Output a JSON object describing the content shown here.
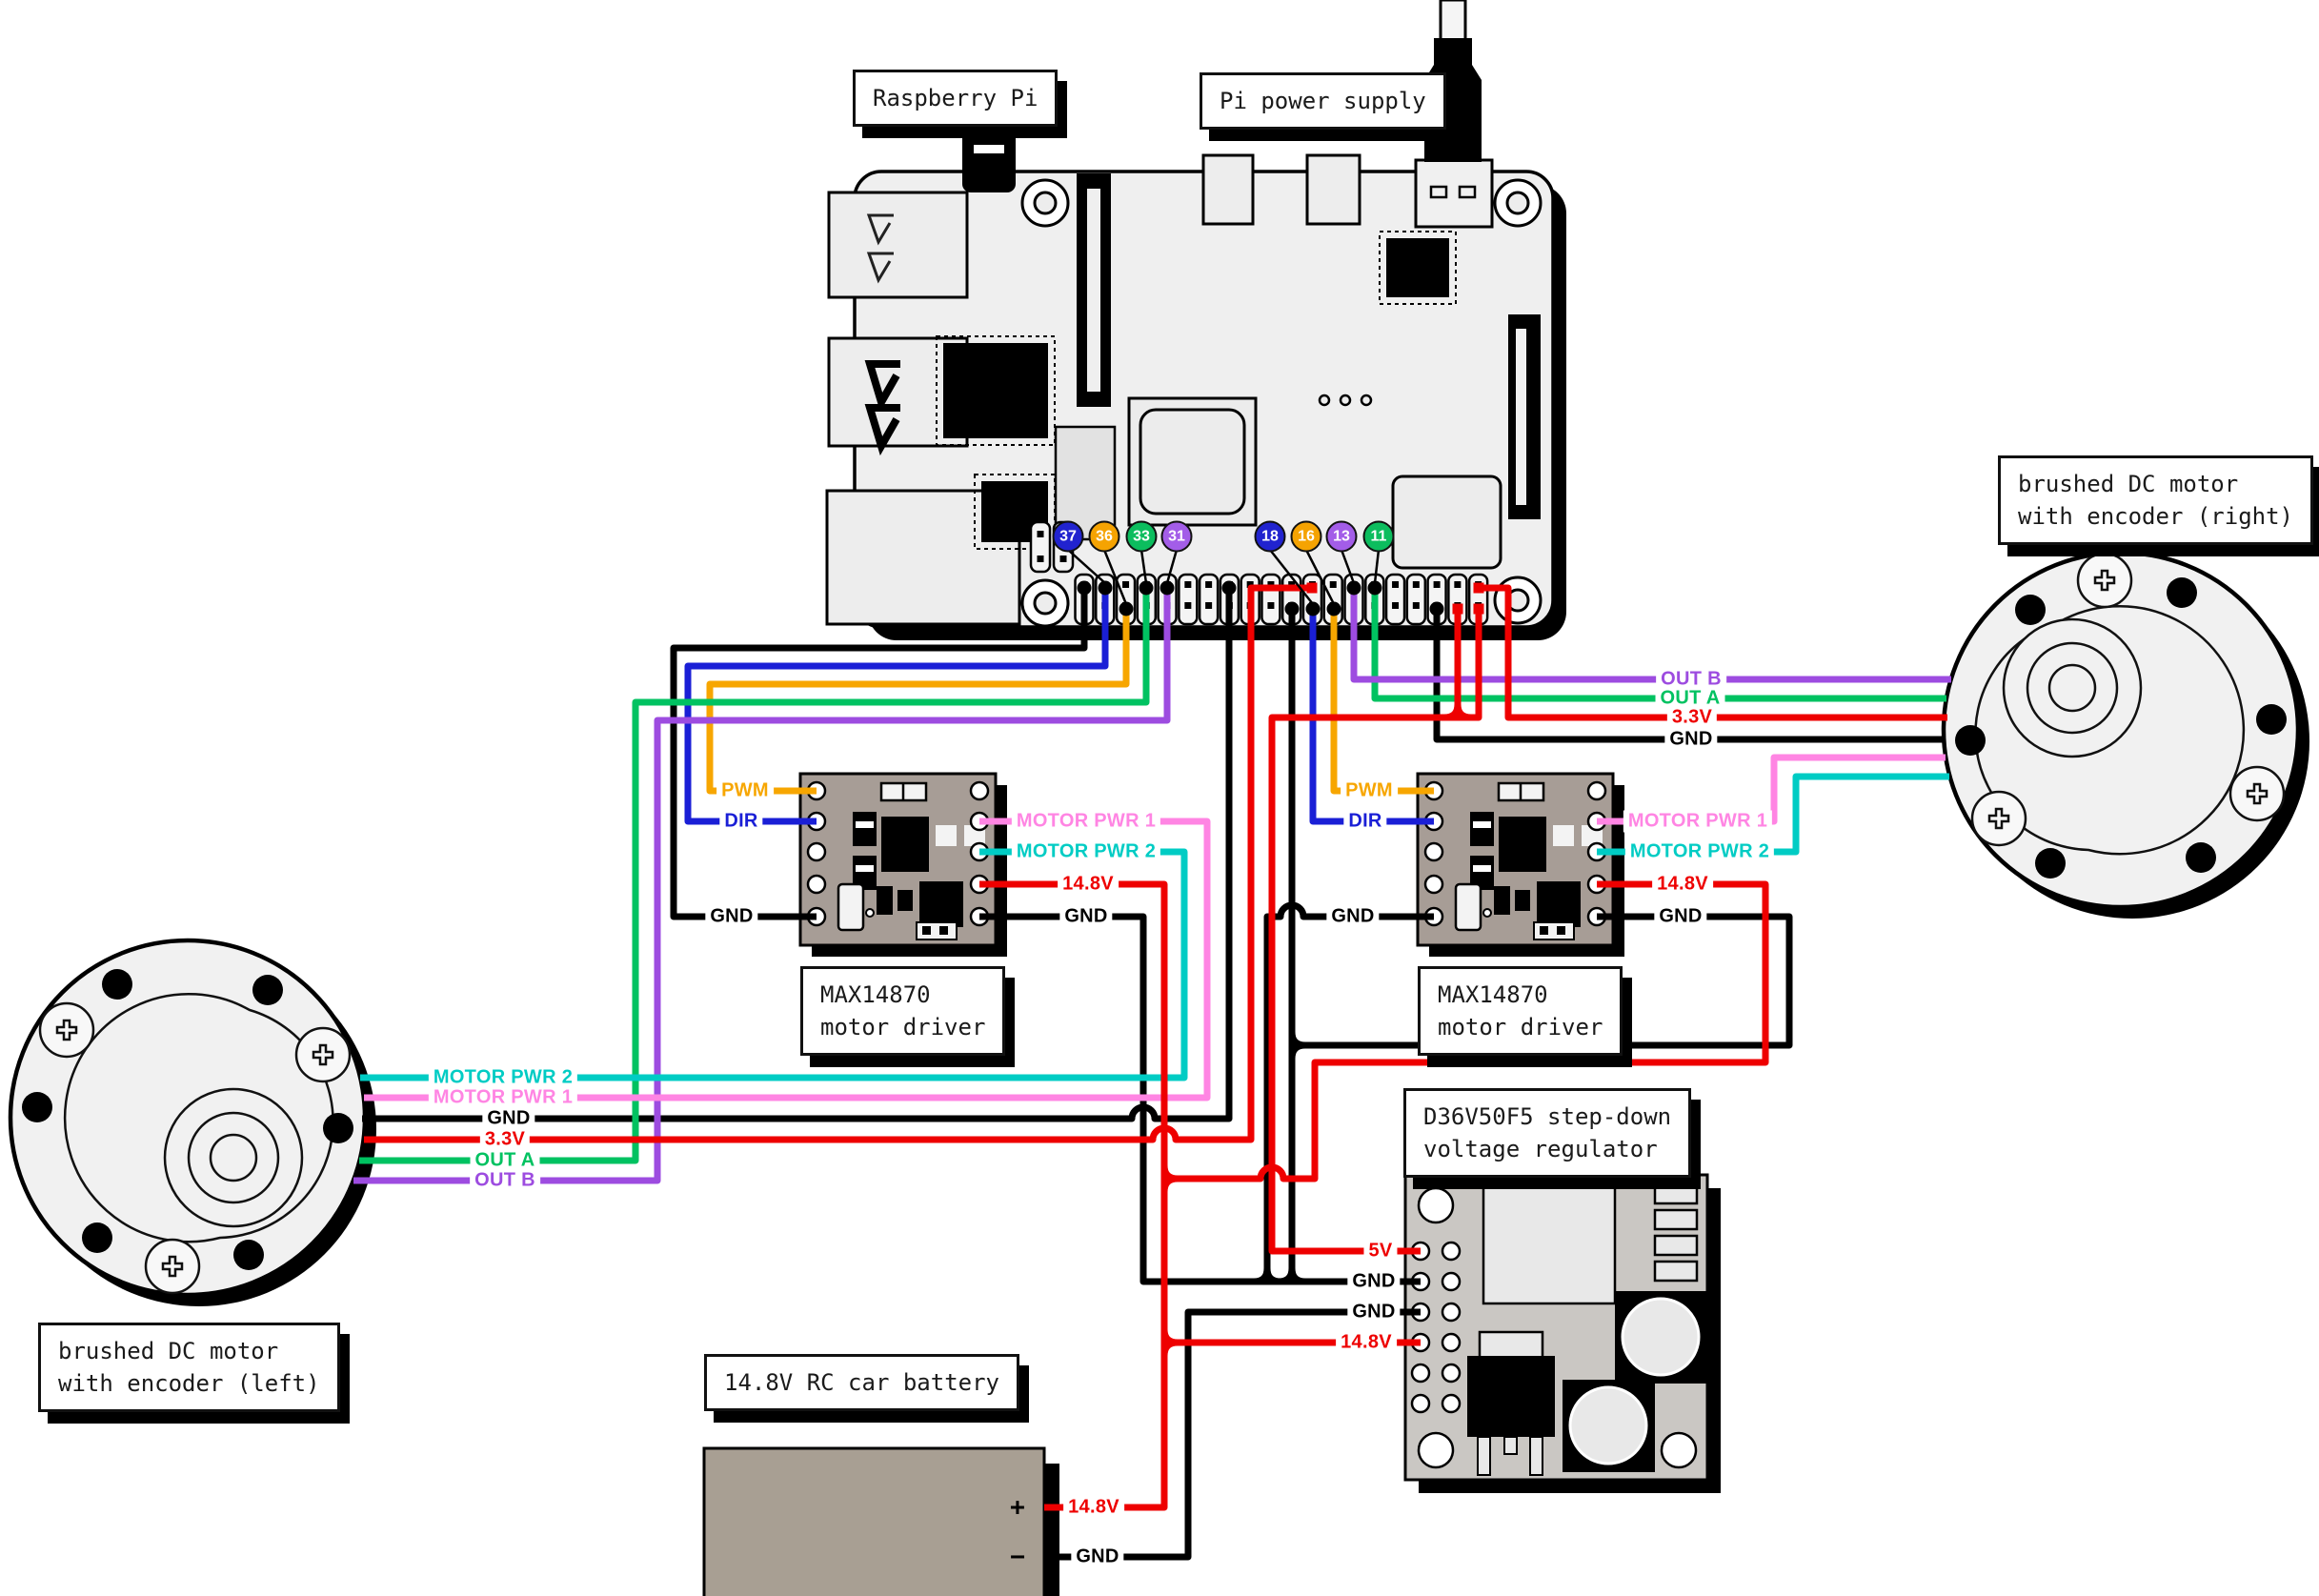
{
  "labels": {
    "raspberry_pi": "Raspberry Pi",
    "pi_power_supply": "Pi power supply",
    "motor_driver_left": [
      "MAX14870",
      "motor driver"
    ],
    "motor_driver_right": [
      "MAX14870",
      "motor driver"
    ],
    "regulator": [
      "D36V50F5 step-down",
      "voltage regulator"
    ],
    "battery": "14.8V RC car battery",
    "motor_left": [
      "brushed DC motor",
      "with encoder (left)"
    ],
    "motor_right": [
      "brushed DC motor",
      "with encoder (right)"
    ]
  },
  "gpio": {
    "badges": [
      {
        "pin": "37",
        "color": "#2123cf"
      },
      {
        "pin": "36",
        "color": "#f5a302"
      },
      {
        "pin": "33",
        "color": "#0cbd5e"
      },
      {
        "pin": "31",
        "color": "#a35de8"
      },
      {
        "pin": "18",
        "color": "#2123cf"
      },
      {
        "pin": "16",
        "color": "#f5a302"
      },
      {
        "pin": "13",
        "color": "#a35de8"
      },
      {
        "pin": "11",
        "color": "#0cbd5e"
      }
    ]
  },
  "wire_labels": {
    "left_driver": {
      "pwm": "PWM",
      "dir": "DIR",
      "gnd_in": "GND",
      "motor_pwr_1": "MOTOR PWR 1",
      "motor_pwr_2": "MOTOR PWR 2",
      "v148": "14.8V",
      "gnd_out": "GND"
    },
    "right_driver": {
      "pwm": "PWM",
      "dir": "DIR",
      "gnd_in": "GND",
      "motor_pwr_1": "MOTOR PWR 1",
      "motor_pwr_2": "MOTOR PWR 2",
      "v148": "14.8V",
      "gnd_out": "GND"
    },
    "left_motor": {
      "motor_pwr_2": "MOTOR PWR 2",
      "motor_pwr_1": "MOTOR PWR 1",
      "gnd": "GND",
      "v33": "3.3V",
      "out_a": "OUT A",
      "out_b": "OUT B"
    },
    "right_motor": {
      "out_b": "OUT B",
      "out_a": "OUT A",
      "v33": "3.3V",
      "gnd": "GND"
    },
    "regulator": {
      "v5": "5V",
      "gnd1": "GND",
      "gnd2": "GND",
      "v148": "14.8V"
    },
    "battery": {
      "v148": "14.8V",
      "gnd": "GND",
      "plus": "+",
      "minus": "−"
    }
  },
  "wire_colors": {
    "pwm": "#f7a600",
    "dir": "#1a1fd6",
    "gnd": "#000000",
    "motor_pwr_1": "#ff85e3",
    "motor_pwr_2": "#00ccc4",
    "power_14_8v": "#ee0000",
    "v3_3": "#ee0000",
    "v5": "#ee0000",
    "out_a": "#00c261",
    "out_b": "#9d4ce0"
  }
}
